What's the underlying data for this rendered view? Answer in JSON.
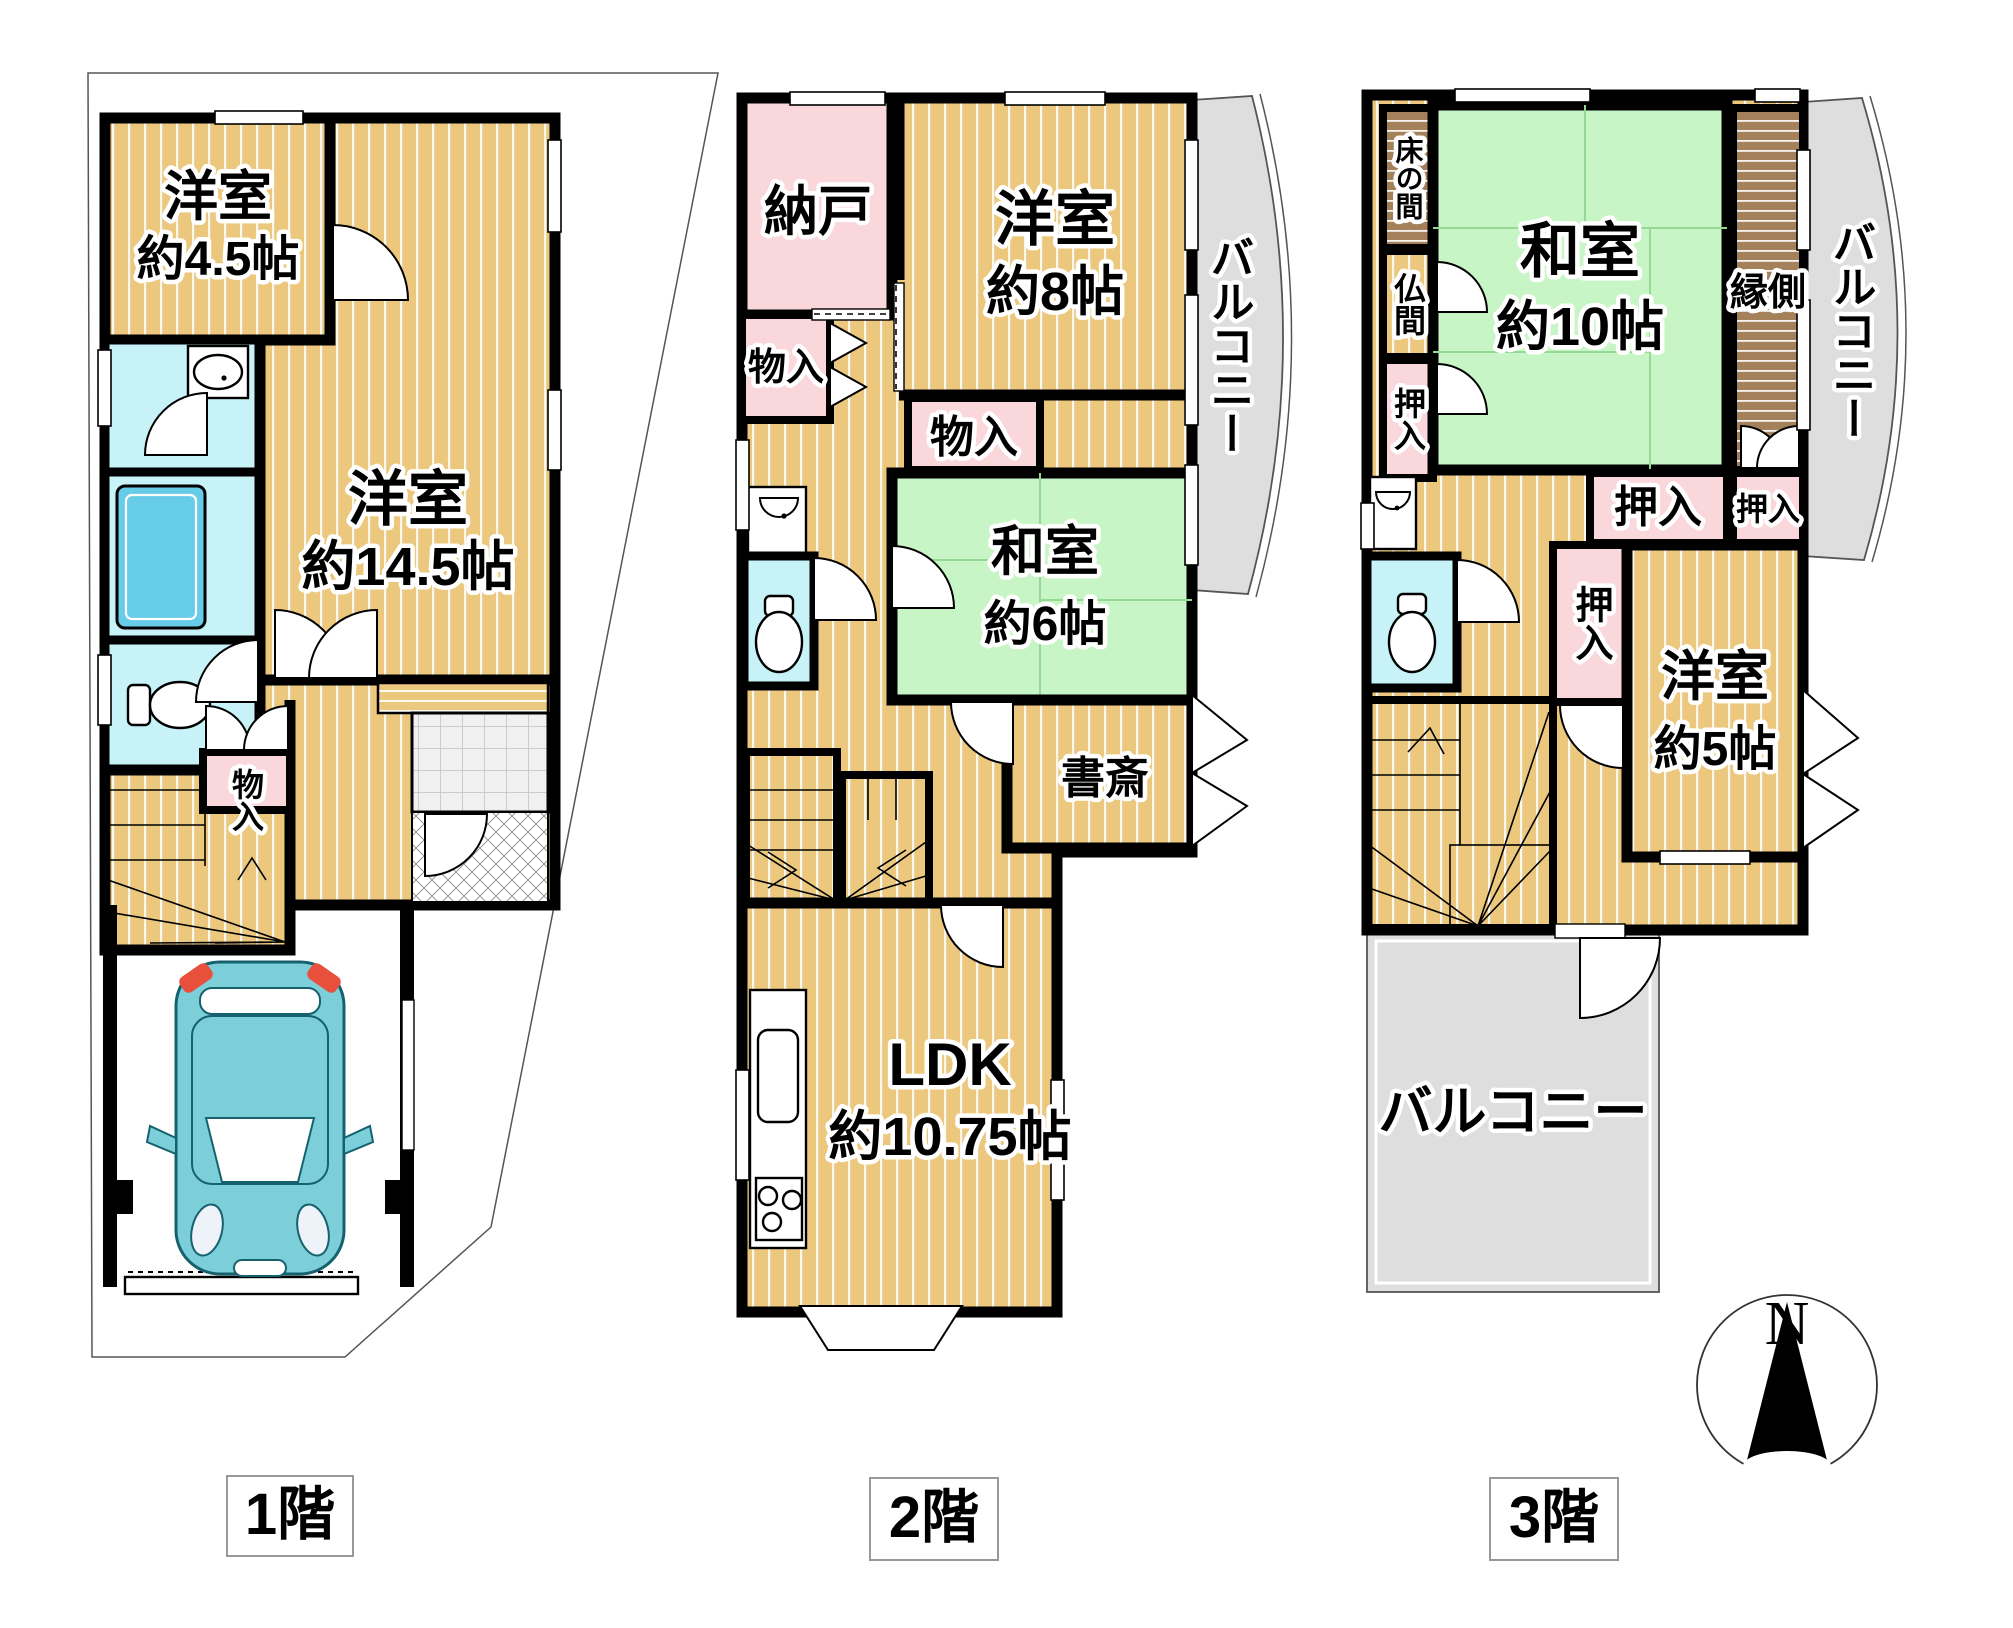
{
  "page_title": "間取り図",
  "floor1": {
    "label": "1階",
    "rooms": {
      "western45": {
        "line1": "洋室",
        "line2": "約4.5帖"
      },
      "western145": {
        "line1": "洋室",
        "line2": "約14.5帖"
      },
      "storage": "物入"
    }
  },
  "floor2": {
    "label": "2階",
    "rooms": {
      "nando": "納戸",
      "storage_left": "物入",
      "western8": {
        "line1": "洋室",
        "line2": "約8帖"
      },
      "storage_mid": "物入",
      "washitsu6": {
        "line1": "和室",
        "line2": "約6帖"
      },
      "study": "書斎",
      "ldk": {
        "line1": "LDK",
        "line2": "約10.75帖"
      },
      "balcony": "バルコニー"
    }
  },
  "floor3": {
    "label": "3階",
    "rooms": {
      "tokonoma": "床の間",
      "butsuma": "仏間",
      "oshiire_left": "押入",
      "washitsu10": {
        "line1": "和室",
        "line2": "約10帖"
      },
      "engawa": "縁側",
      "balcony_side": "バルコニー",
      "oshiire_wide": "押入",
      "oshiire_small": "押入",
      "oshiire_tall": "押入",
      "western5": {
        "line1": "洋室",
        "line2": "約5帖"
      },
      "balcony_bottom": "バルコニー"
    }
  },
  "compass": {
    "north_label": "N"
  },
  "colors": {
    "wood_floor": "#EBC87E",
    "tatami_green": "#C8F5C5",
    "closet_pink": "#F9D7DB",
    "water_cyan": "#C6F2F8",
    "bathtub_blue": "#66CCE8",
    "balcony_gray": "#DEDEDE",
    "engawa_brown": "#A4815A",
    "car_teal": "#7CCFD8",
    "wall_black": "#000000"
  }
}
